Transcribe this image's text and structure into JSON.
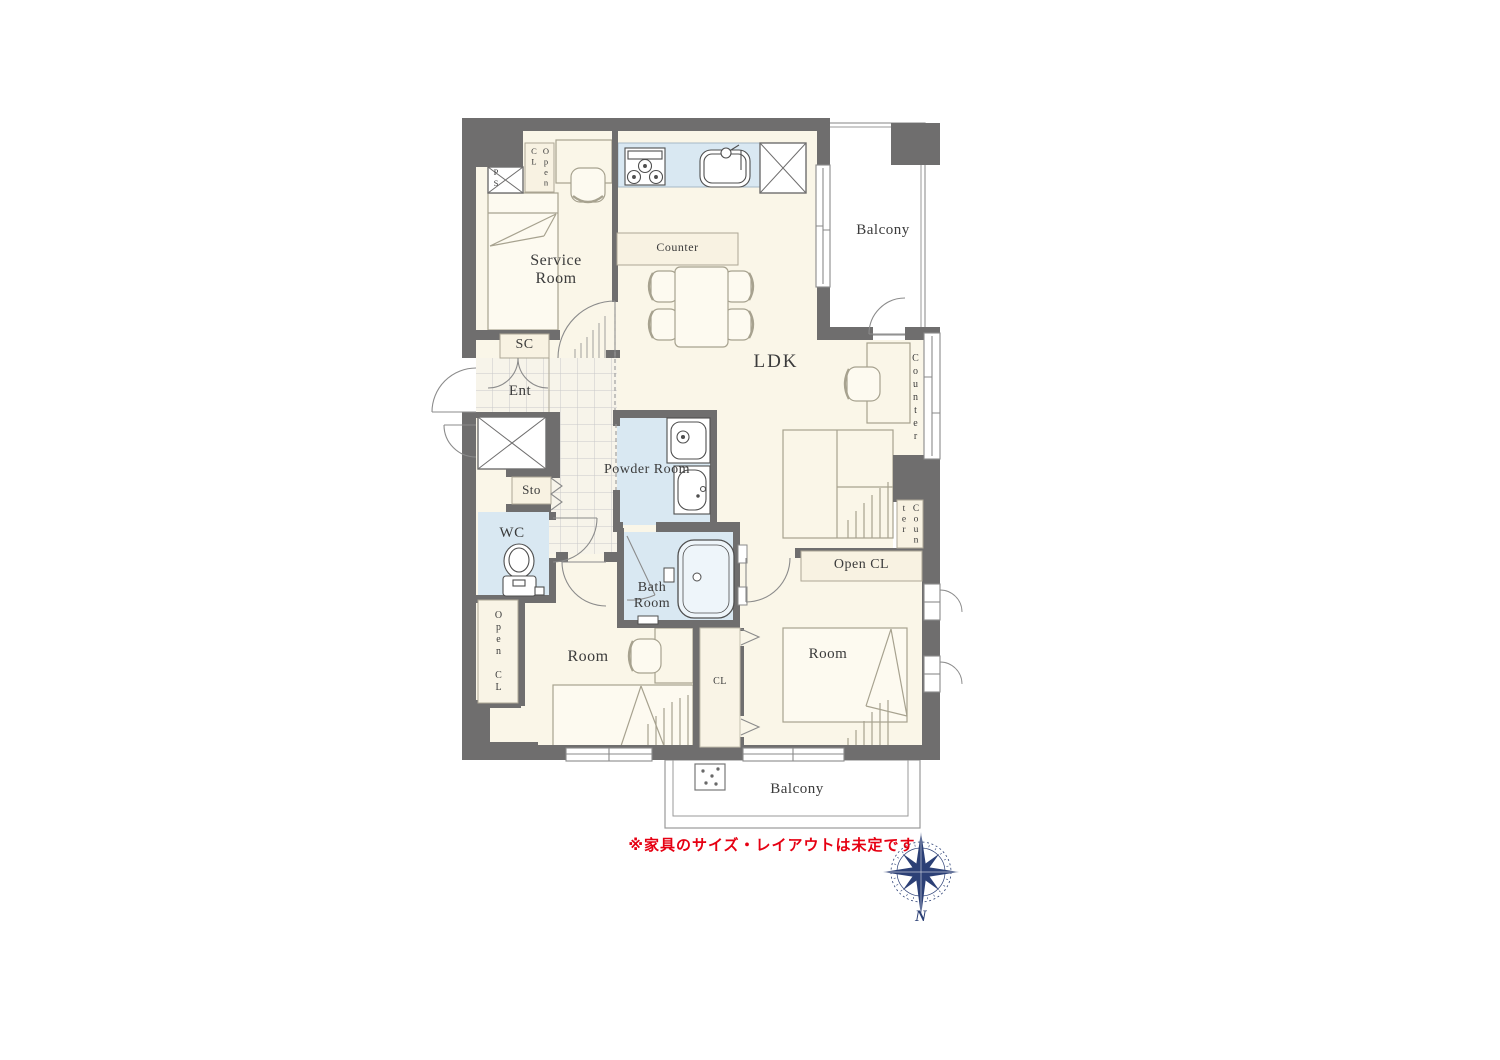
{
  "labels": {
    "balcony_top": "Balcony",
    "service_room": "Service Room",
    "ps": "PS",
    "open_cl_top": "Open CL",
    "counter_island": "Counter",
    "ldk": "LDK",
    "counter_window": "Counter",
    "counter_lower": "Counter",
    "sc": "SC",
    "ent": "Ent",
    "sto": "Sto",
    "wc": "WC",
    "open_cl_left": "Open CL",
    "powder_room": "Powder Room",
    "bath_room": "Bath Room",
    "open_cl_right": "Open CL",
    "room_left": "Room",
    "room_right": "Room",
    "cl": "CL",
    "balcony_bottom": "Balcony",
    "note": "※家具のサイズ・レイアウトは未定です",
    "compass_n": "N"
  },
  "colors": {
    "wall": "#6f6e6e",
    "floor": "#faf6e8",
    "wet_area": "#d9e8f2",
    "label_box": "#f8f2e2",
    "furniture_line": "#a7a28f",
    "note_red": "#e60012",
    "compass_navy": "#2c4076"
  }
}
